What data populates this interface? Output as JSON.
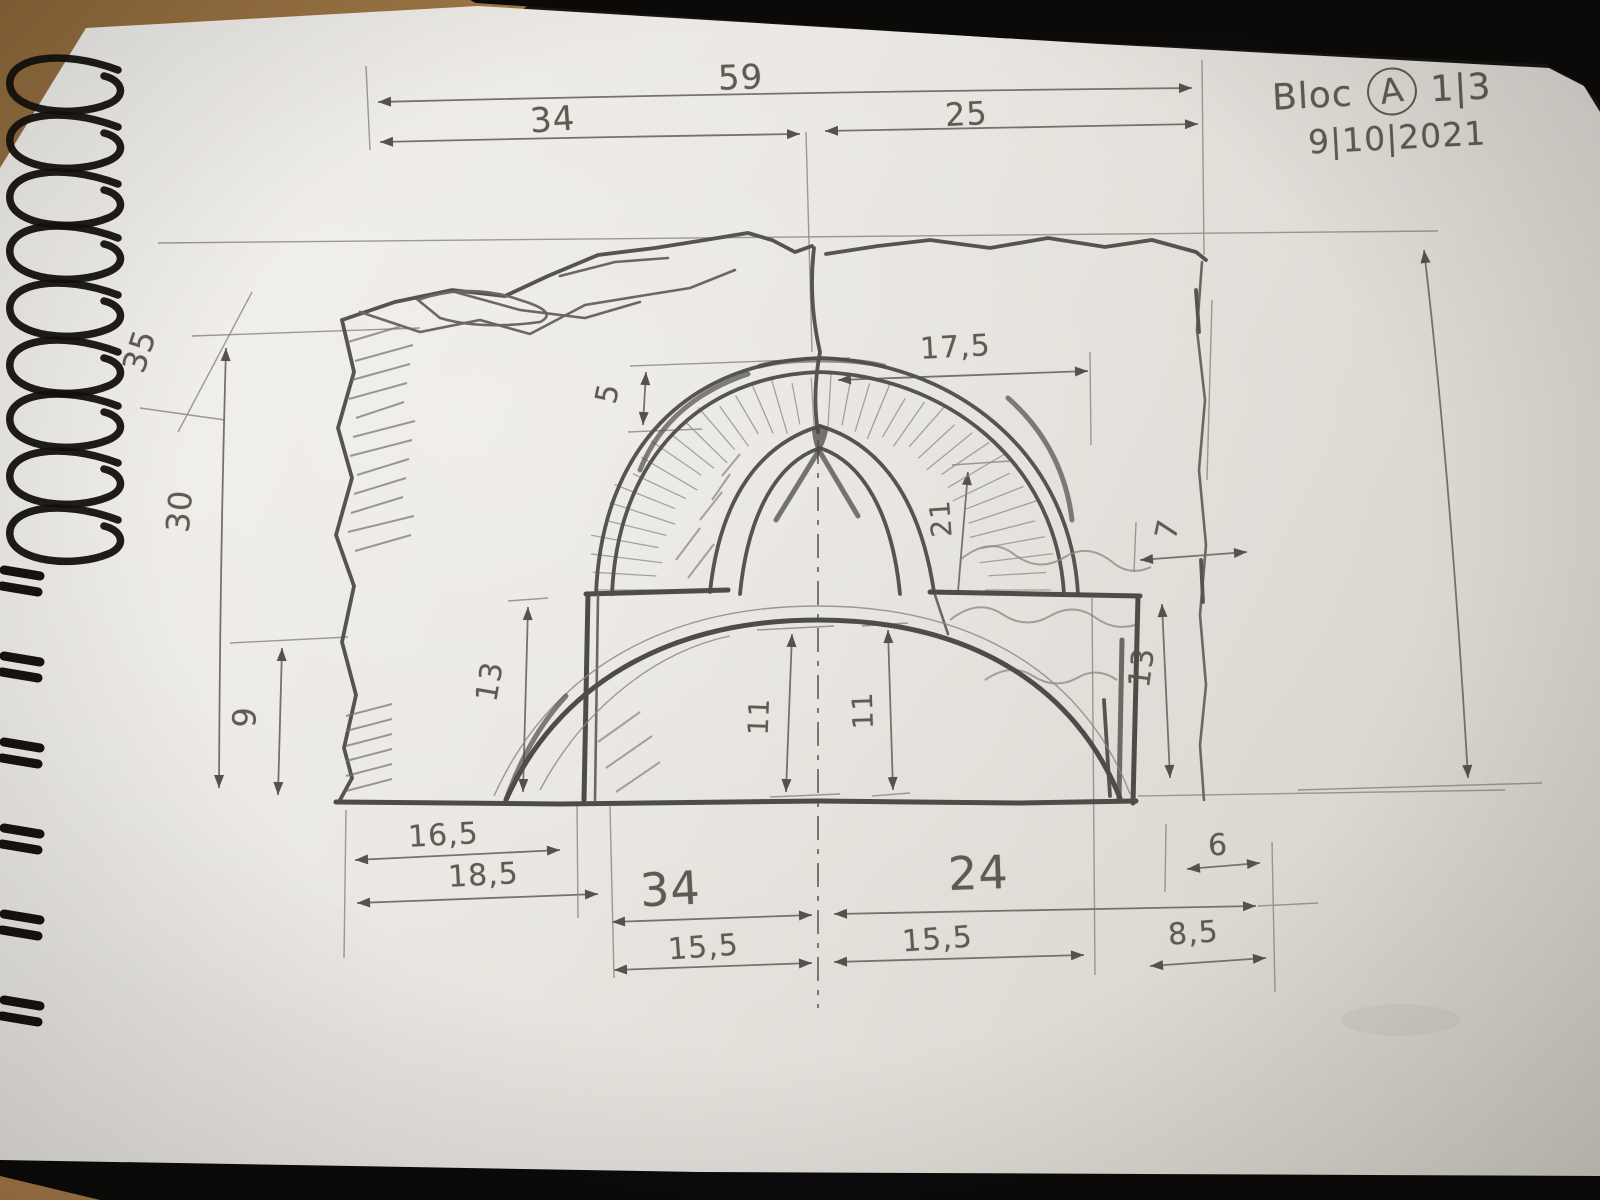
{
  "sheet": {
    "label": "Bloc",
    "block_letter": "A",
    "page_fraction": "1|3",
    "date": "9|10|2021"
  },
  "dims": {
    "total_width": "59",
    "upper_left_width": "34",
    "upper_right_width": "25",
    "left_top_height": "35",
    "left_height": "30",
    "left_bottom_height": "9",
    "arch_half_width": "17,5",
    "apex_gap": "5",
    "inner_arch_height": "21",
    "right_gap": "7",
    "left_pier_height": "13",
    "right_pier_height": "13",
    "opening_height_left": "11",
    "opening_height_right": "11",
    "bottom_left_pier_width": "16,5",
    "bottom_left_offset": "18,5",
    "bottom_left_span": "34",
    "bottom_right_span": "24",
    "bottom_left_half": "15,5",
    "bottom_right_half": "15,5",
    "bottom_right_gap": "6",
    "bottom_right_offset": "8,5"
  }
}
